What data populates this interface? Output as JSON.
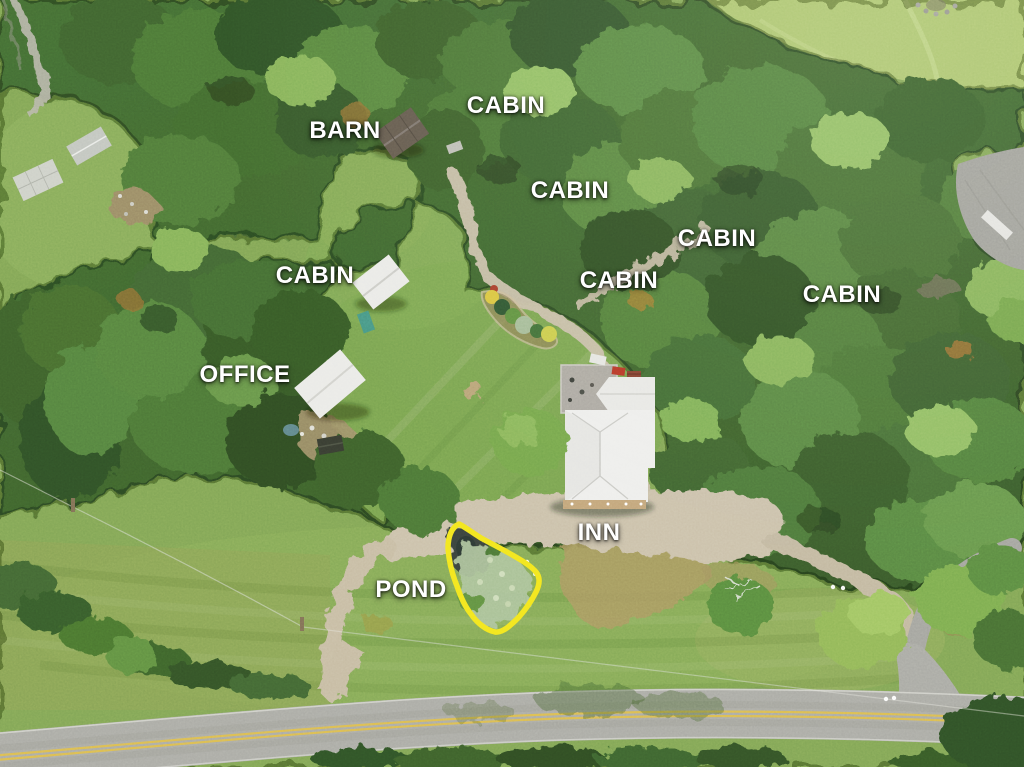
{
  "scene": {
    "type": "aerial-drone-photo-of-inn-property",
    "annotation_style": "white uppercase place labels over photo"
  },
  "labels": [
    {
      "id": "barn",
      "text": "BARN"
    },
    {
      "id": "cabin-top",
      "text": "CABIN"
    },
    {
      "id": "cabin-upper-middle",
      "text": "CABIN"
    },
    {
      "id": "cabin-right-upper",
      "text": "CABIN"
    },
    {
      "id": "cabin-middle",
      "text": "CABIN"
    },
    {
      "id": "cabin-far-right",
      "text": "CABIN"
    },
    {
      "id": "cabin-left",
      "text": "CABIN"
    },
    {
      "id": "office",
      "text": "OFFICE"
    },
    {
      "id": "inn",
      "text": "INN"
    },
    {
      "id": "pond",
      "text": "POND"
    }
  ],
  "colors": {
    "label_text": "#ffffff",
    "pond_outline": "#f2e41e",
    "road_centerline_yellow": "#d9b84e"
  }
}
